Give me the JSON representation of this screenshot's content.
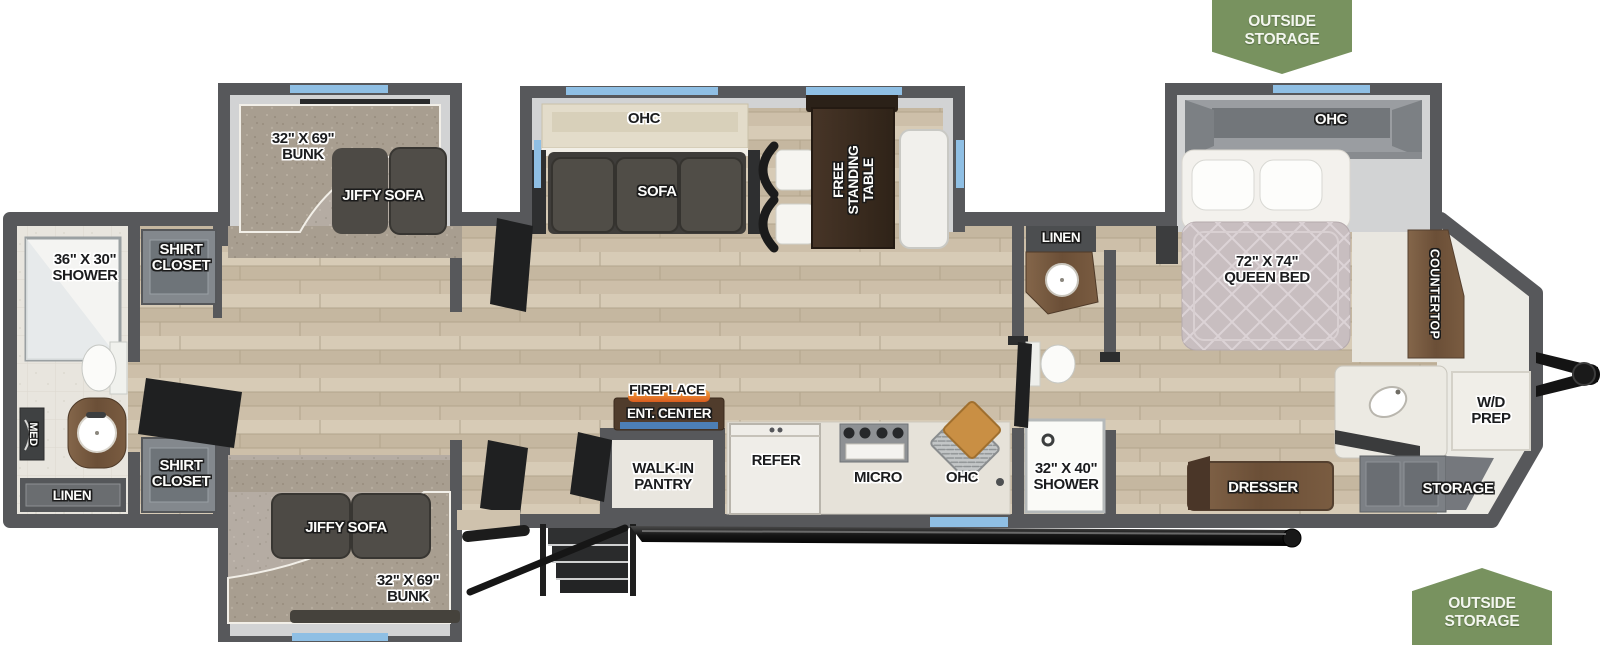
{
  "banners": {
    "top_text": "OUTSIDE\nSTORAGE",
    "bottom_text": "OUTSIDE\nSTORAGE"
  },
  "labels": {
    "bunk_top": "32\" X 69\"\nBUNK",
    "jiffy_sofa_top": "JIFFY SOFA",
    "shower_rear": "36\" X 30\"\nSHOWER",
    "shirt_closet_top": "SHIRT\nCLOSET",
    "med": "MED",
    "linen_rear": "LINEN",
    "shirt_closet_bottom": "SHIRT\nCLOSET",
    "jiffy_sofa_bottom": "JIFFY SOFA",
    "bunk_bottom": "32\" X 69\"\nBUNK",
    "ohc_living": "OHC",
    "sofa": "SOFA",
    "free_standing_table": "FREE\nSTANDING\nTABLE",
    "fireplace": "FIREPLACE",
    "ent_center": "ENT. CENTER",
    "walk_in_pantry": "WALK-IN\nPANTRY",
    "refer": "REFER",
    "micro": "MICRO",
    "ohc_kitchen": "OHC",
    "linen_mid": "LINEN",
    "shower_mid": "32\" X 40\"\nSHOWER",
    "ohc_bedroom": "OHC",
    "queen_bed": "72\" X 74\"\nQUEEN BED",
    "countertop": "COUNTERTOP",
    "wd_prep": "W/D\nPREP",
    "dresser": "DRESSER",
    "storage": "STORAGE"
  },
  "colors": {
    "wall": "#57585b",
    "slide_wall_face": "#d2d3d4",
    "wood_floor": "#cfc2ad",
    "carpet": "#b5aca3",
    "bunk_pad": "#a89e90",
    "window_blue": "#8fbfe4",
    "banner_green": "#78925f",
    "fireplace_flame": "#e8752c",
    "fireplace_accent": "#4d7fb5",
    "dark_furniture": "#4a4742",
    "wood_furniture": "#6e5440",
    "bed_quilt": "#c8bec0"
  }
}
